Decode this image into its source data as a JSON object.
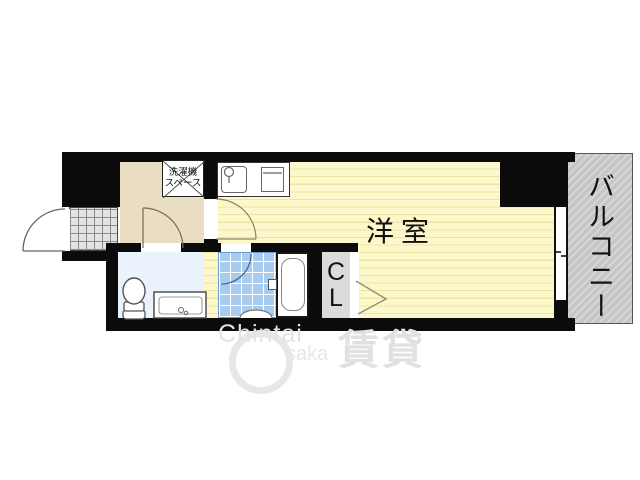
{
  "plan": {
    "type": "apartment-floor-plan",
    "rooms": {
      "main_room": {
        "label": "洋室"
      },
      "balcony": {
        "label": "バルコニー"
      },
      "closet": {
        "letters": [
          "C",
          "L"
        ]
      },
      "washer_space": {
        "line1": "洗濯機",
        "line2": "スペース"
      }
    },
    "fixtures": [
      "entrance-door",
      "hall-door",
      "room-door",
      "bath-door",
      "kitchen-sink",
      "stove",
      "bathtub",
      "toilet",
      "vanity-sink",
      "genkan-tile",
      "window-to-balcony",
      "closet-folding-door"
    ],
    "colors": {
      "wall": "#0b0b0b",
      "room_floor": "#fcf8cc",
      "room_stripe": "#ece4a2",
      "hallway_floor": "#e9ddc2",
      "bathroom_tile": "#a9cbed",
      "washroom_floor": "#eaf2fb",
      "closet_fill": "#dbdbdb",
      "balcony_gray": "#c6c6c6",
      "watermark_gray": "#e4e4e4"
    }
  },
  "watermark": {
    "latin_top": "Chintai",
    "latin_bottom": "saka",
    "kanji": "賃貸"
  }
}
